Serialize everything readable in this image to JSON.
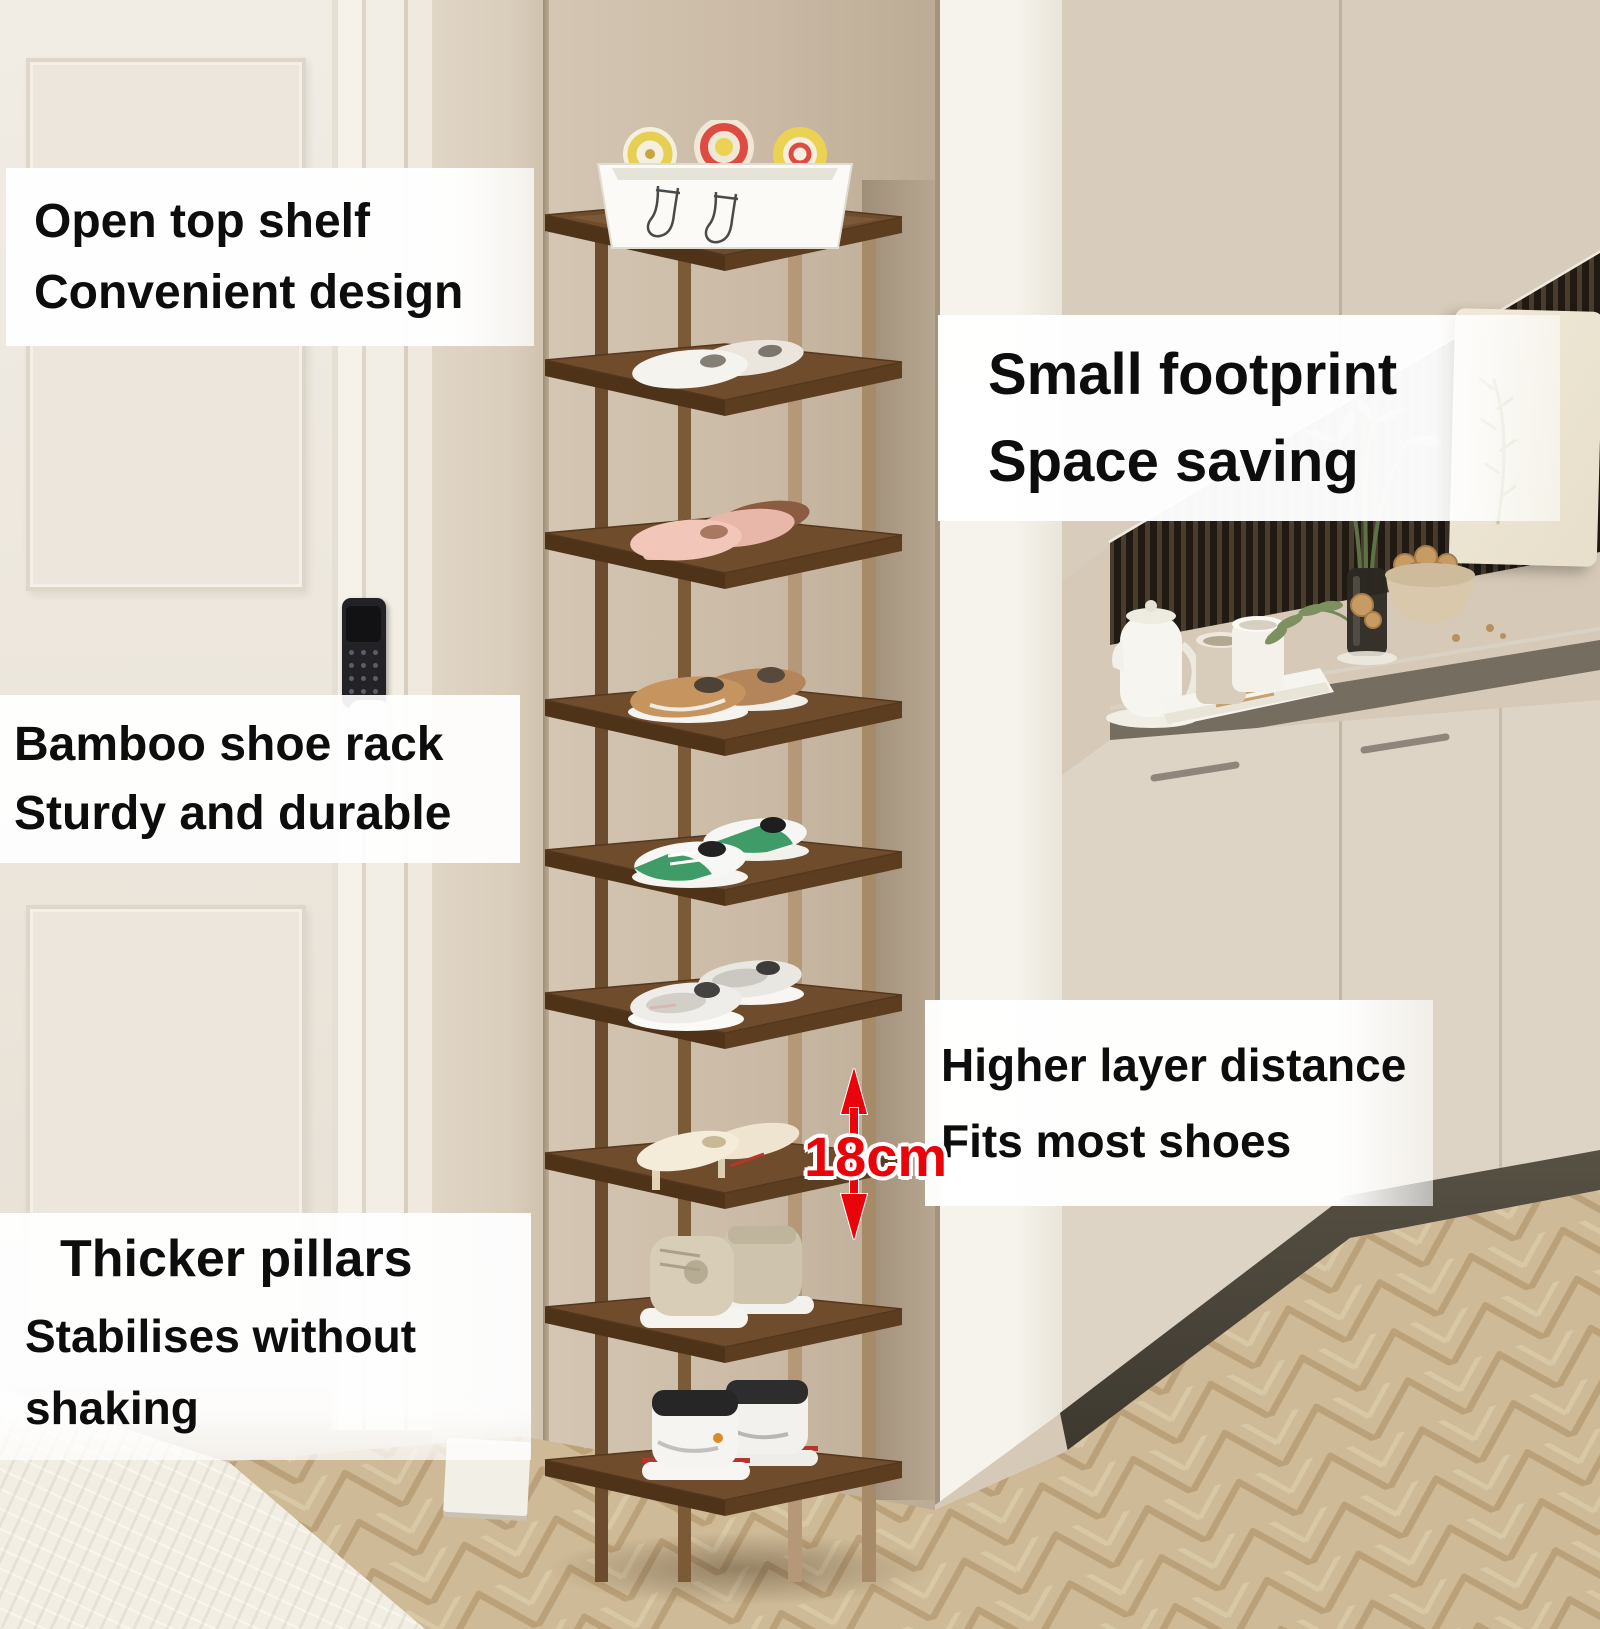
{
  "annotations": {
    "top_left": {
      "line1": "Open top shelf",
      "line2": "Convenient design"
    },
    "right_top": {
      "line1": "Small footprint",
      "line2": "Space saving"
    },
    "mid_left": {
      "line1": "Bamboo shoe rack",
      "line2": "Sturdy and durable"
    },
    "right_mid": {
      "line1": "Higher layer distance",
      "line2": "Fits most shoes"
    },
    "bottom_left": {
      "line1": "Thicker pillars",
      "line2": "Stabilises without shaking"
    },
    "measurement": {
      "label": "18cm"
    }
  },
  "colors": {
    "accent_red": "#e8040a",
    "shelf_wood": "#6d4b2b",
    "post_wood": "#b59877",
    "wall_beige": "#d2c4b1",
    "counter_dark": "#37322c",
    "cabinet_cream": "#ddd4c6",
    "floor_tan": "#dcc9a6",
    "callout_text": "#0d0d0d",
    "callout_bg": "#ffffff"
  },
  "rack": {
    "tier_count": 9,
    "layer_gap_label": "18cm",
    "tiers": [
      "storage-basket-with-rolled-towels",
      "white-flats",
      "pink-heeled-mules",
      "brown-casual-sneakers",
      "green-white-sneakers",
      "white-knit-sneakers",
      "cream-high-heels",
      "beige-high-top-boots",
      "white-high-top-sneakers"
    ]
  },
  "scene_objects": {
    "left": [
      "white-door",
      "smart-lock",
      "door-handle"
    ],
    "center": [
      "bamboo-shoe-rack"
    ],
    "right": [
      "kitchen-counter",
      "kettle",
      "cups",
      "plant",
      "walnut-bowl",
      "cream-cabinets",
      "slat-wall"
    ],
    "floor": [
      "herringbone-parquet",
      "white-rug"
    ]
  }
}
